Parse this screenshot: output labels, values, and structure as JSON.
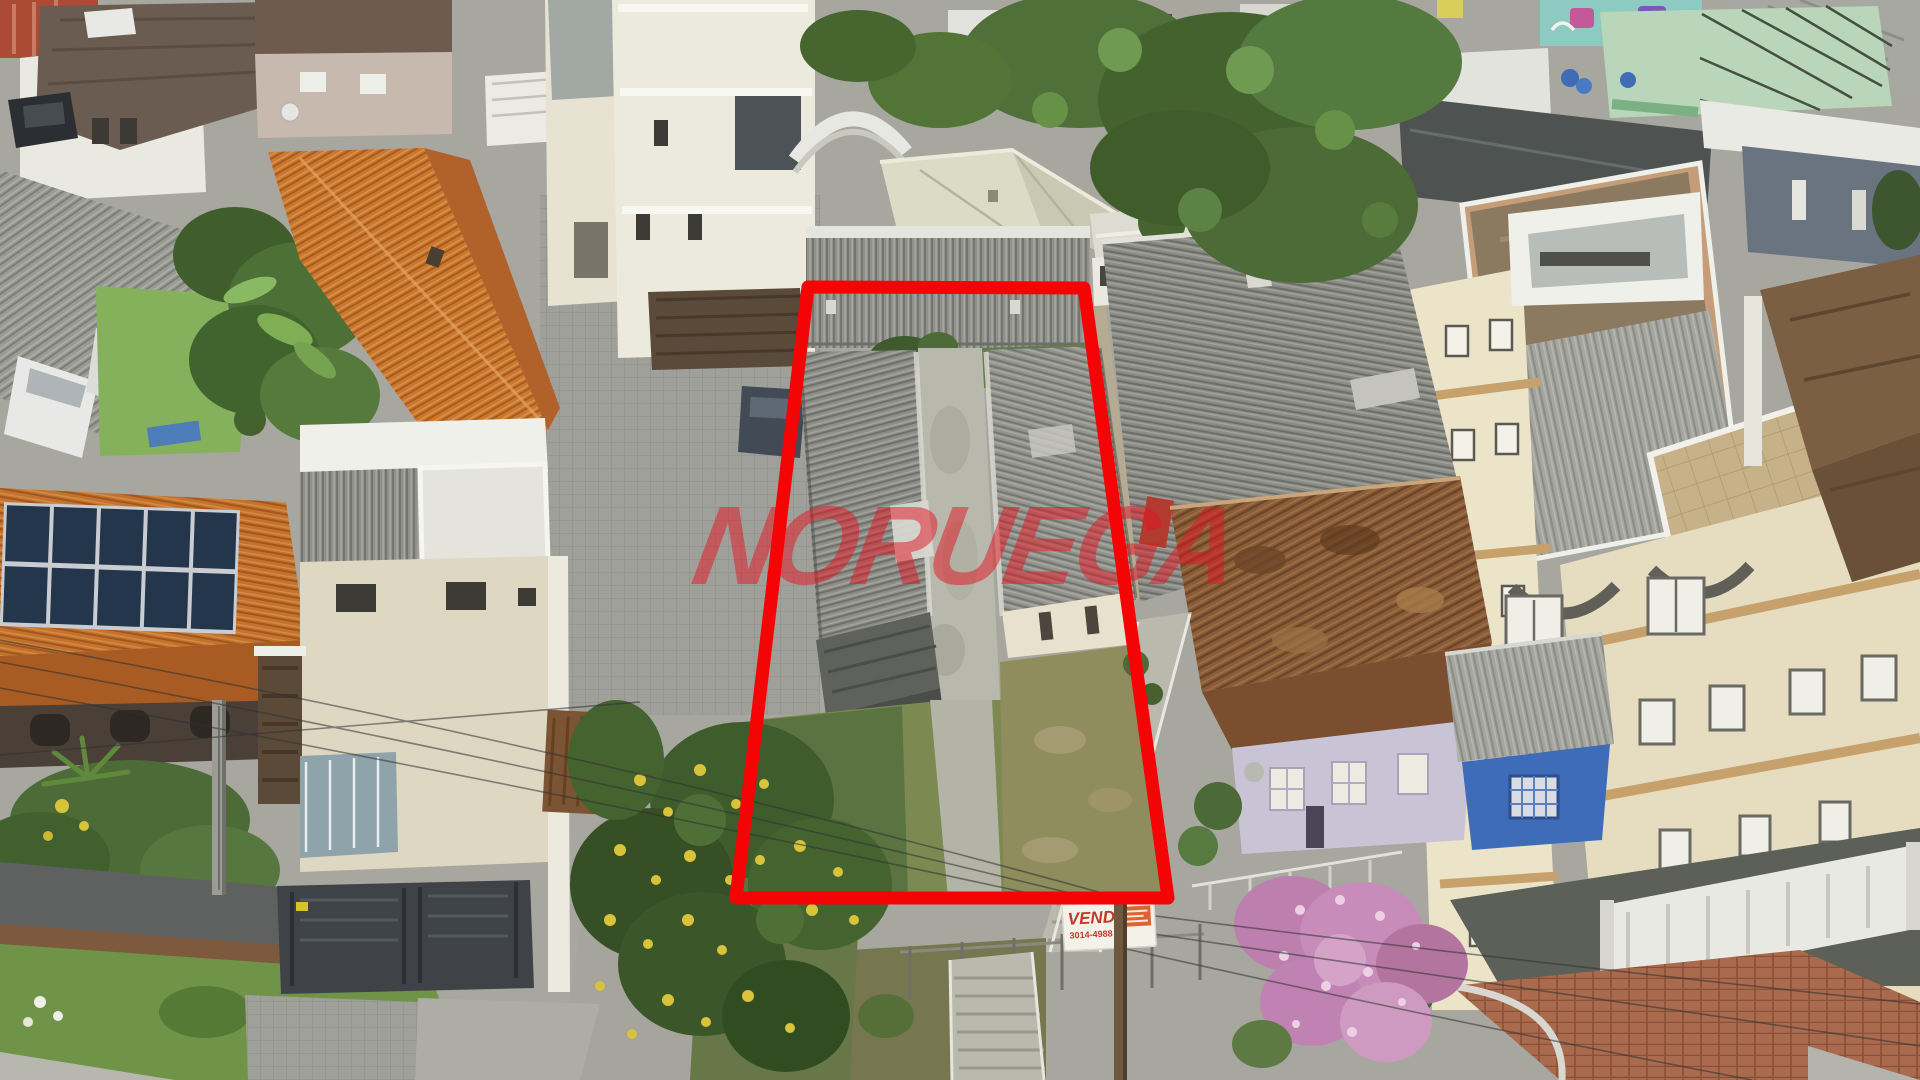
{
  "photo": {
    "kind": "aerial drone photograph",
    "subject": "residential block in overcast daylight with a red outline marking a deep narrow lot for sale",
    "width_px": 1920,
    "height_px": 1080
  },
  "watermark": {
    "text": "NORUEGA",
    "color": "#e41422",
    "opacity": 0.5
  },
  "lot_outline": {
    "points": "808,287 1084,288 1168,898 736,898",
    "color": "#f40404",
    "stroke_width": 13
  },
  "sale_sign": {
    "title": "VENDE",
    "phone": "3014-4988",
    "title_color": "#c0392b",
    "background": "#f4f1e8",
    "brand_patch_color": "#df6330"
  },
  "scene": {
    "features": [
      "twin rows of gray corrugated roofs inside the outlined lot",
      "central concrete walkway between the rows",
      "overgrown lawn with yellow-flowering tree at lot front",
      "orange clay-tile roofed houses on the left",
      "rooftop solar panel array on far-left house",
      "white modern three-storey house with dark metal gates",
      "banana trees and carport with parked white cars at top left",
      "beige apartment building with satellite dishes, curved balconies and tiled terrace on the right",
      "lilac house with weathered brown tile roof and blue shed",
      "pink flowering tree at lower right",
      "street corner with sidewalk, grass verge, utility poles and power lines",
      "mint-green warehouse and graffiti wall at top right"
    ]
  }
}
